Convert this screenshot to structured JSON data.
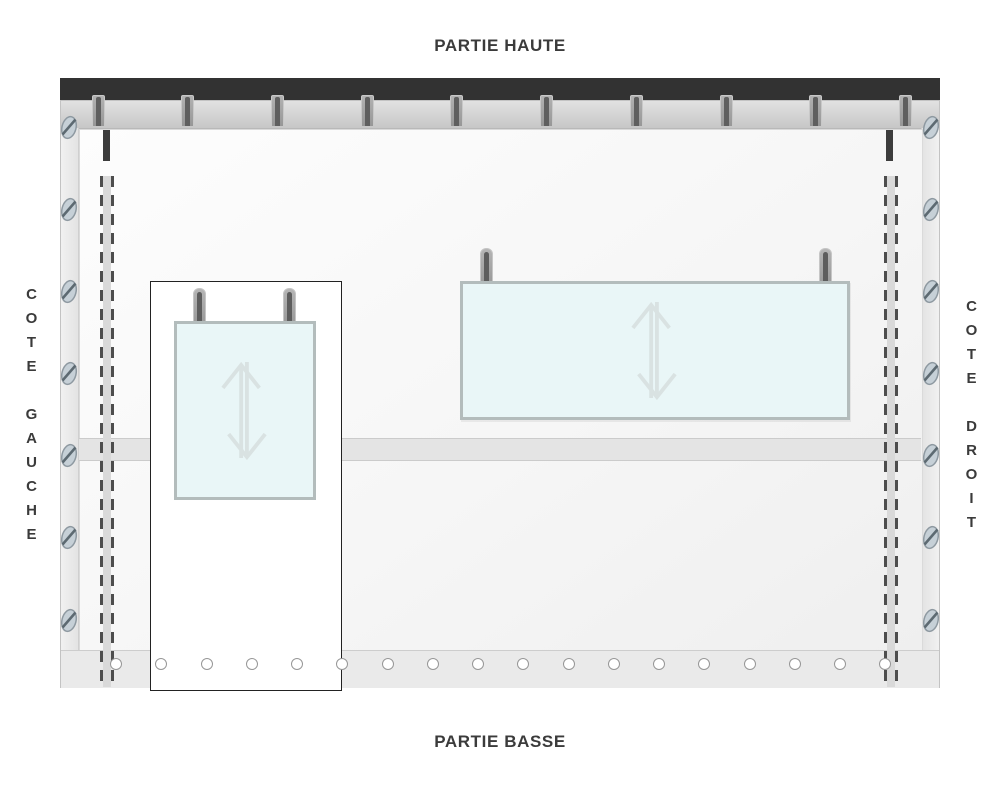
{
  "labels": {
    "top": "PARTIE HAUTE",
    "bottom": "PARTIE BASSE",
    "left_side": "COTE GAUCHE",
    "right_side": "COTE DROIT"
  },
  "diagram": {
    "description_parts": {
      "rail": "top fixing rail",
      "rail_hooks_count": 10,
      "side_screws_count_per_side": 7,
      "eyelets_count": 18,
      "seam_lines": "double dashed stitch lines near left and right edges",
      "windows": [
        {
          "name": "left-window",
          "hooks_count": 2,
          "icon": "up-down-arrow-icon",
          "framed_by_outline_box": true
        },
        {
          "name": "right-window",
          "hooks_count": 2,
          "icon": "up-down-arrow-icon",
          "framed_by_outline_box": false
        }
      ]
    },
    "icons": {
      "window_arrow": "up-down-arrow-icon",
      "fastener": "screw-icon",
      "rail_hook": "hook-icon",
      "eyelet": "eyelet-icon"
    },
    "colors": {
      "rail": "#323232",
      "tarp_hem": "#d5d5d5",
      "panel": "#f6f6f6",
      "band": "#e4e4e4",
      "window_fill": "#e9f6f7",
      "window_border": "#b3bcbc",
      "arrow": "#d9e2e2",
      "hook_core": "#5f5f5f",
      "screw_fill": "#c6d0d7",
      "screw_border": "#8e99a1",
      "dash": "#4d4d4d",
      "text": "#3b3b3b"
    }
  }
}
